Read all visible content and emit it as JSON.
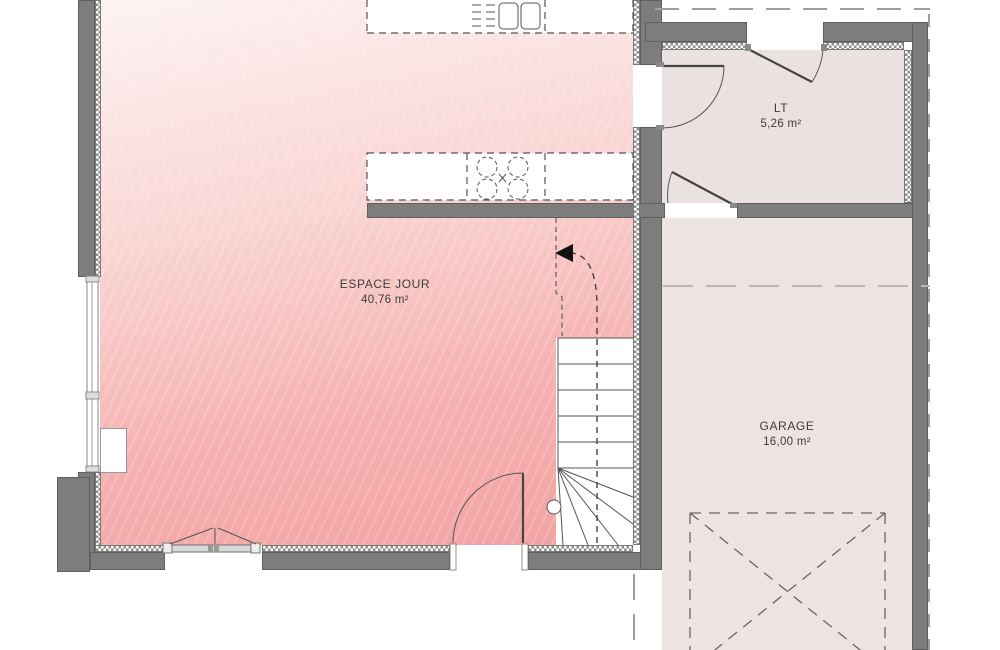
{
  "plan_title": "floor-plan-ground-level",
  "rooms": [
    {
      "name": "ESPACE JOUR",
      "area": "40,76 m²"
    },
    {
      "name": "LT",
      "area": "5,26 m²"
    },
    {
      "name": "GARAGE",
      "area": "16,00 m²"
    }
  ],
  "icons": {
    "stairs_arrow": "stairs-direction-arrow"
  },
  "colors": {
    "room-pink-light": "#fdf3f2",
    "room-pink-dark": "#f2a2a2",
    "floor-neutral": "#eae2e1",
    "floor-garage": "#ece4e1",
    "wall": "#7d7d7d",
    "wall-edge": "#5f5f5f",
    "line": "#555555",
    "boundary-dash": "#9e9e9e"
  }
}
